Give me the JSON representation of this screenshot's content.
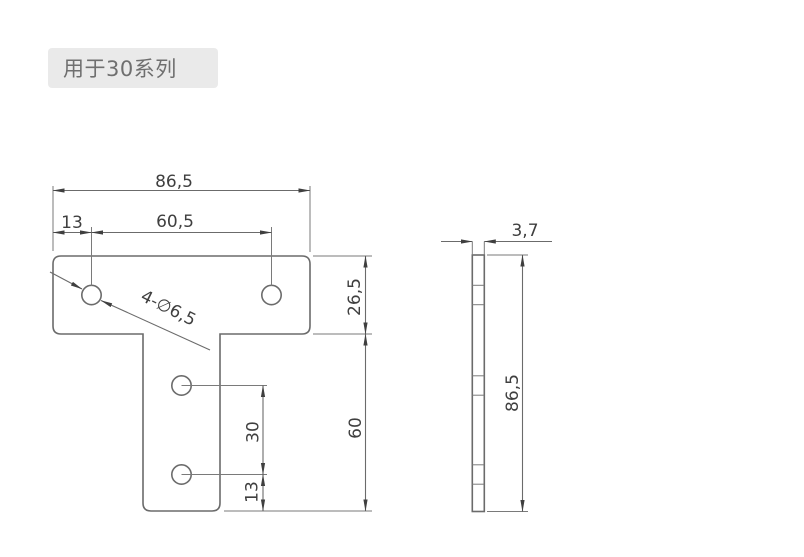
{
  "badge": {
    "label": "用于30系列"
  },
  "colors": {
    "background": "#ffffff",
    "badge_bg": "#eaeaea",
    "badge_text": "#6f6f6f",
    "drawing_lines": "#6b6b6b",
    "dimension_text": "#3f3f3f"
  },
  "front_view": {
    "description": "T-shaped flat connector plate, front view, 4 holes",
    "dims": {
      "total_width": "86,5",
      "left_hole_offset": "13",
      "top_hole_spacing": "60,5",
      "hole_callout": "4-∅6,5",
      "flange_height": "26,5",
      "stem_height": "60",
      "stem_hole_spacing": "30",
      "bottom_hole_offset": "13"
    }
  },
  "side_view": {
    "description": "Plate side profile with hidden hole edges",
    "dims": {
      "thickness": "3,7",
      "height": "86,5"
    }
  }
}
